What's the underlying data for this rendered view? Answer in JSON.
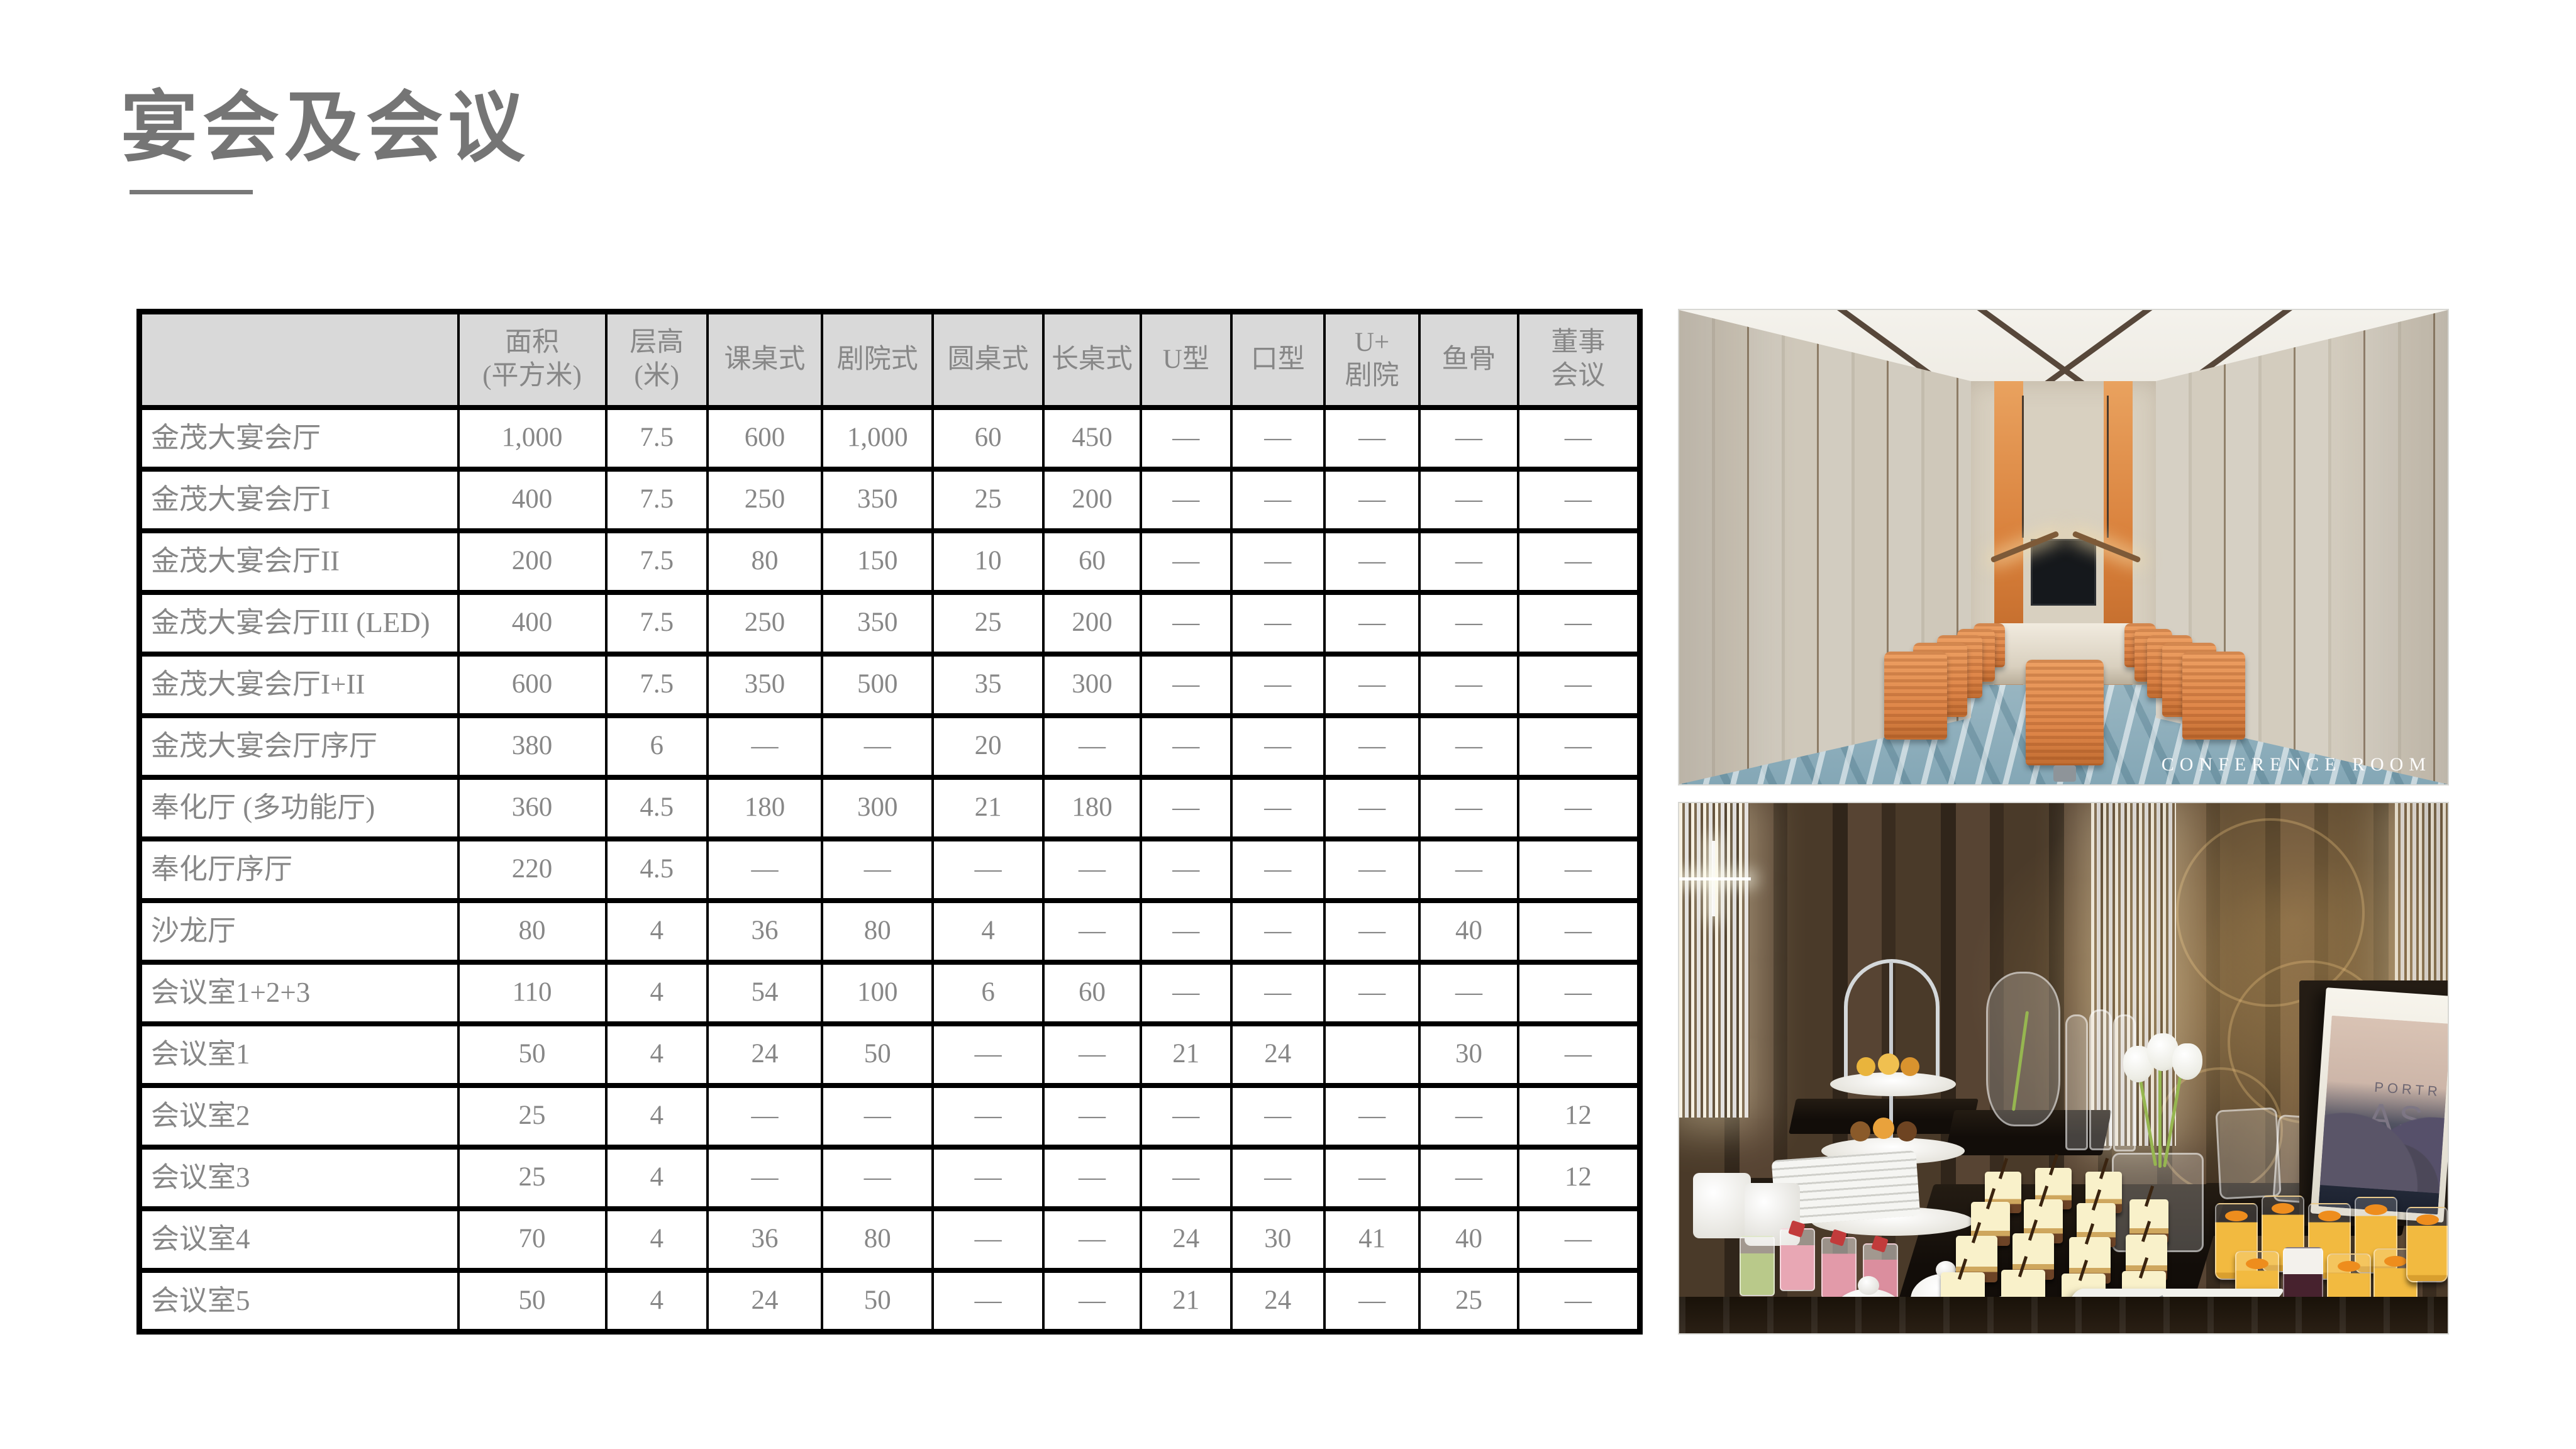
{
  "page": {
    "title": "宴会及会议"
  },
  "table": {
    "headers": [
      "",
      "面积\n(平方米)",
      "层高\n(米)",
      "课桌式",
      "剧院式",
      "圆桌式",
      "长桌式",
      "U型",
      "口型",
      "U+\n剧院",
      "鱼骨",
      "董事\n会议"
    ],
    "rows": [
      {
        "name": "金茂大宴会厅",
        "values": [
          "1,000",
          "7.5",
          "600",
          "1,000",
          "60",
          "450",
          "—",
          "—",
          "—",
          "—",
          "—"
        ]
      },
      {
        "name": "金茂大宴会厅I",
        "values": [
          "400",
          "7.5",
          "250",
          "350",
          "25",
          "200",
          "—",
          "—",
          "—",
          "—",
          "—"
        ]
      },
      {
        "name": "金茂大宴会厅II",
        "values": [
          "200",
          "7.5",
          "80",
          "150",
          "10",
          "60",
          "—",
          "—",
          "—",
          "—",
          "—"
        ]
      },
      {
        "name": "金茂大宴会厅III (LED)",
        "values": [
          "400",
          "7.5",
          "250",
          "350",
          "25",
          "200",
          "—",
          "—",
          "—",
          "—",
          "—"
        ]
      },
      {
        "name": "金茂大宴会厅I+II",
        "values": [
          "600",
          "7.5",
          "350",
          "500",
          "35",
          "300",
          "—",
          "—",
          "—",
          "—",
          "—"
        ]
      },
      {
        "name": "金茂大宴会厅序厅",
        "values": [
          "380",
          "6",
          "—",
          "—",
          "20",
          "—",
          "—",
          "—",
          "—",
          "—",
          "—"
        ]
      },
      {
        "name": "奉化厅 (多功能厅)",
        "values": [
          "360",
          "4.5",
          "180",
          "300",
          "21",
          "180",
          "—",
          "—",
          "—",
          "—",
          "—"
        ]
      },
      {
        "name": "奉化厅序厅",
        "values": [
          "220",
          "4.5",
          "—",
          "—",
          "—",
          "—",
          "—",
          "—",
          "—",
          "—",
          "—"
        ]
      },
      {
        "name": "沙龙厅",
        "values": [
          "80",
          "4",
          "36",
          "80",
          "4",
          "—",
          "—",
          "—",
          "—",
          "40",
          "—"
        ]
      },
      {
        "name": "会议室1+2+3",
        "values": [
          "110",
          "4",
          "54",
          "100",
          "6",
          "60",
          "—",
          "—",
          "—",
          "—",
          "—"
        ]
      },
      {
        "name": "会议室1",
        "values": [
          "50",
          "4",
          "24",
          "50",
          "—",
          "—",
          "21",
          "24",
          "",
          "30",
          "—"
        ]
      },
      {
        "name": "会议室2",
        "values": [
          "25",
          "4",
          "—",
          "—",
          "—",
          "—",
          "—",
          "—",
          "—",
          "—",
          "12"
        ]
      },
      {
        "name": "会议室3",
        "values": [
          "25",
          "4",
          "—",
          "—",
          "—",
          "—",
          "—",
          "—",
          "—",
          "—",
          "12"
        ]
      },
      {
        "name": "会议室4",
        "values": [
          "70",
          "4",
          "36",
          "80",
          "—",
          "—",
          "24",
          "30",
          "41",
          "40",
          "—"
        ]
      },
      {
        "name": "会议室5",
        "values": [
          "50",
          "4",
          "24",
          "50",
          "—",
          "—",
          "21",
          "24",
          "—",
          "25",
          "—"
        ]
      }
    ]
  },
  "photos": {
    "conference_room": {
      "caption": "CONFERENCE ROOM"
    },
    "dessert_buffet": {
      "book_line1": "PORTR",
      "book_line2": "AS"
    }
  },
  "colors": {
    "title_gray": "#757575",
    "table_text_gray": "#878787",
    "header_fill": "#d9d9d9",
    "accent_orange": "#dd8447",
    "carpet_blue": "#8fb2c0"
  }
}
